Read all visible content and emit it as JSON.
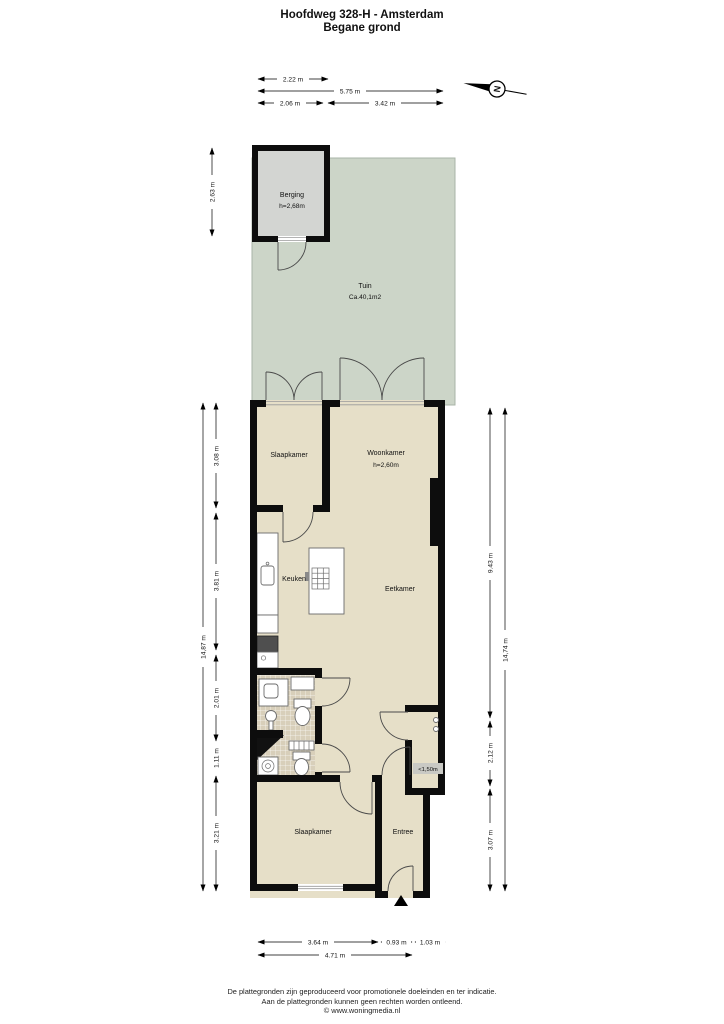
{
  "title": {
    "line1": "Hoofdweg 328-H - Amsterdam",
    "line2": "Begane grond"
  },
  "compass": {
    "north_label": "N"
  },
  "rooms": {
    "berging": {
      "label": "Berging",
      "height": "h=2,68m"
    },
    "tuin": {
      "label": "Tuin",
      "area": "Ca.40,1m2"
    },
    "slaapkamer_top": {
      "label": "Slaapkamer"
    },
    "woonkamer": {
      "label": "Woonkamer",
      "height": "h=2,60m"
    },
    "keuken": {
      "label": "Keuken"
    },
    "eetkamer": {
      "label": "Eetkamer"
    },
    "kast": {
      "label": "<1,50m"
    },
    "slaapkamer_bottom": {
      "label": "Slaapkamer"
    },
    "entree": {
      "label": "Entree"
    }
  },
  "dimensions": {
    "top": {
      "berging_width": "2.22 m",
      "total_width": "5.75 m",
      "left_width": "2.06 m",
      "right_width": "3.42 m"
    },
    "left": {
      "berging_depth": "2.63 m",
      "total": "14,87 m",
      "seg1": "3.08 m",
      "seg2": "3.81 m",
      "seg3": "2.01 m",
      "seg4": "1.11 m",
      "seg5": "3.21 m"
    },
    "right": {
      "seg1": "9.43 m",
      "seg2": "2.12 m",
      "seg3": "3.07 m",
      "total": "14,74 m"
    },
    "bottom": {
      "seg1": "3.64 m",
      "seg2": "0.93 m",
      "seg3": "1.03 m",
      "total": "4.71 m"
    }
  },
  "footer": {
    "line1": "De plattegronden zijn geproduceerd voor promotionele doeleinden en ter indicatie.",
    "line2": "Aan de plattegronden kunnen geen rechten worden ontleend.",
    "line3": "© www.woningmedia.nl"
  },
  "colors": {
    "garden": "#ccd5c8",
    "interior": "#e6dfc8",
    "berging": "#d3d5d2",
    "tile": "#d8cfba",
    "wall": "#0d0d0d",
    "badge": "#c9c9c4"
  }
}
